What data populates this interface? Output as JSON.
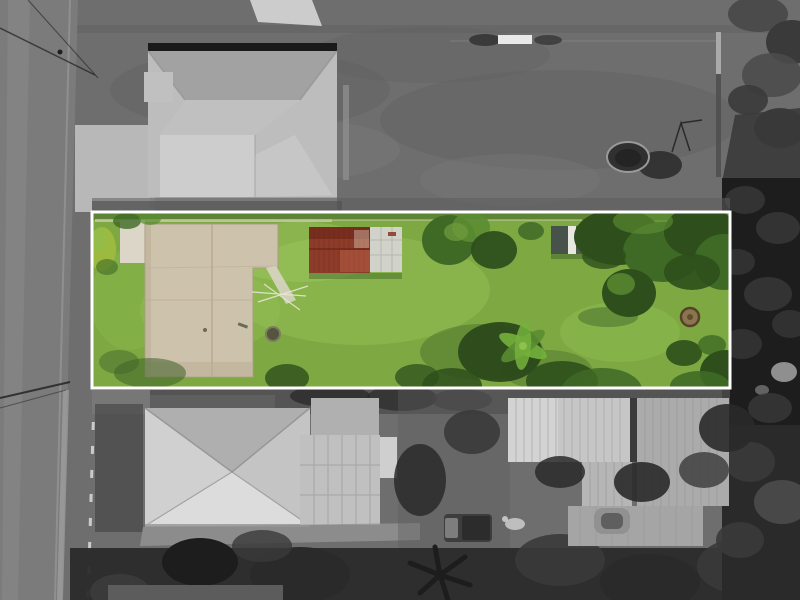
{
  "image": {
    "kind_label": "aerial-property-highlight-photo",
    "highlight": {
      "border_width": "3"
    }
  },
  "colors": {
    "field": "#6e6e6e",
    "field_dark": "#5c5c5c",
    "field_light": "#808080",
    "road": "#7b7b7b",
    "road_light": "#929292",
    "road_edge": "#9d9d9d",
    "path_light": "#b4b4b4",
    "concrete": "#c0c0c0",
    "concrete_light": "#d6d6d6",
    "concrete_mid": "#aaaaaa",
    "ridge_dark": "#1a1a1a",
    "roof_base": "#bdbdbd",
    "roof_dark": "#a2a2a2",
    "roof_mid": "#c0c0c0",
    "roof_light": "#cdcdcd",
    "roof_face": "#c6c6c6",
    "house2_base": "#c4c4c4",
    "house2_dark": "#aaaaaa",
    "house2_light": "#d0d0d0",
    "house2_bright": "#dcdcdc",
    "valley": "#8f8f8f",
    "eave": "#9c9c9c",
    "garage": "#c0c0c0",
    "garage_top": "#b0b0b0",
    "panel_light": "#cfcfcf",
    "grid_line": "#9a9a9a",
    "shedA": "#c6c6c6",
    "shedA_light": "#d3d3d3",
    "shedB": "#ababab",
    "shedC": "#a5a5a5",
    "shedM": "#b6b6b6",
    "corrugation": "#949494",
    "gap_dark": "#3a3a3a",
    "tree_black": "#1d1d1d",
    "tree_dark": "#2a2a2a",
    "tree_mid": "#3a3a3a",
    "tree_gray": "#4b4b4b",
    "tree_pale": "#8f8f8f",
    "ground_dark": "#3c3c3c",
    "band_dark": "#4e4e4e",
    "strip_mid": "#6a6a6a",
    "pool_water": "#303030",
    "pool_rim": "#9a9a9a",
    "white_object": "#e9e9e9",
    "fence_white": "#dcdcdc",
    "wire_dark": "#1f1f1f",
    "truck_body": "#3d3d3d",
    "truck_cab": "#7d7d7d",
    "debris_white": "#cccccc",
    "boat_gray": "#919191",
    "boat_dark": "#5f5f5f",
    "border_white": "#ffffff",
    "grass": "#7da842",
    "grass_light": "#93bf54",
    "grass_pale": "#a6cc68",
    "grass_shadow": "#3f6128",
    "green_dark": "#2e4f1c",
    "green_mid": "#3f6a26",
    "green_light": "#5b8c32",
    "green_pale": "#6f9c3c",
    "bush_yellow": "#9cba40",
    "palm_green": "#74b13c",
    "palm_light": "#8ec04e",
    "palm_shadow": "#2c4a1a",
    "slab": "#cdc2ac",
    "slab_edge": "#a89c82",
    "slab_joint": "#b2a68c",
    "slab_pale": "#dcd6c9",
    "slab_shade": "#b9ad92",
    "red_roof": "#8e3c2a",
    "red_dark": "#6e2819",
    "red_light": "#c06a50",
    "red_fleck": "#d7c3b0",
    "pad_white": "#d1d2ca",
    "pad_line": "#a9aaa2",
    "shed_slate": "#47524a",
    "shed_slate2": "#4e5b4e",
    "shed_stripe": "#e8e8e2",
    "stump": "#8a7550",
    "stump_ring": "#544324",
    "pit": "#55543f",
    "pit_ring": "#7d7b60",
    "line_pale": "#e9e5d6"
  }
}
